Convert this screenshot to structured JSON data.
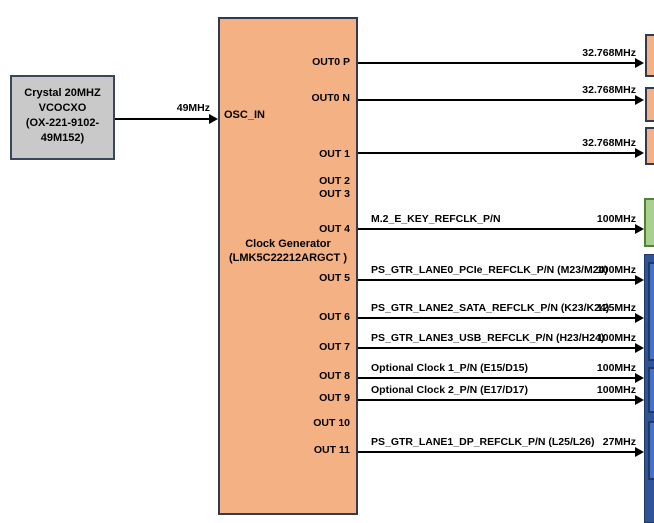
{
  "colors": {
    "orange_fill": "#F4B183",
    "dark_border": "#2F3B52",
    "gray_fill": "#C9C9C9",
    "green_fill": "#A9D18E",
    "green_border": "#538135",
    "blue_outer": "#2F5597",
    "blue_inner": "#4472C4",
    "arrow": "#000000"
  },
  "crystal": {
    "line1": "Crystal 20MHZ",
    "line2": "VCOCXO",
    "line3": "(OX-221-9102-",
    "line4": "49M152)"
  },
  "input": {
    "freq": "49MHz",
    "pin": "OSC_IN"
  },
  "generator": {
    "title1": "Clock Generator",
    "title2": "(LMK5C22212ARGCT )",
    "pins": {
      "p0p": "OUT0 P",
      "p0n": "OUT0 N",
      "p1": "OUT 1",
      "p2": "OUT 2",
      "p3": "OUT 3",
      "p4": "OUT 4",
      "p5": "OUT 5",
      "p6": "OUT 6",
      "p7": "OUT 7",
      "p8": "OUT 8",
      "p9": "OUT 9",
      "p10": "OUT 10",
      "p11": "OUT 11"
    }
  },
  "outputs": {
    "o1": {
      "freq": "32.768MHz"
    },
    "o2": {
      "freq": "32.768MHz"
    },
    "o3": {
      "freq": "32.768MHz"
    },
    "o4": {
      "signal": "M.2_E_KEY_REFCLK_P/N",
      "freq": "100MHz"
    },
    "o5": {
      "signal": "PS_GTR_LANE0_PCIe_REFCLK_P/N (M23/M24)",
      "freq": "100MHz"
    },
    "o6": {
      "signal": "PS_GTR_LANE2_SATA_REFCLK_P/N (K23/K24)",
      "freq": "125MHz"
    },
    "o7": {
      "signal": "PS_GTR_LANE3_USB_REFCLK_P/N (H23/H24)",
      "freq": "100MHz"
    },
    "o8": {
      "signal": "Optional Clock 1_P/N (E15/D15)",
      "freq": "100MHz"
    },
    "o9": {
      "signal": "Optional Clock 2_P/N (E17/D17)",
      "freq": "100MHz"
    },
    "o11": {
      "signal": "PS_GTR_LANE1_DP_REFCLK_P/N (L25/L26)",
      "freq": "27MHz"
    }
  }
}
